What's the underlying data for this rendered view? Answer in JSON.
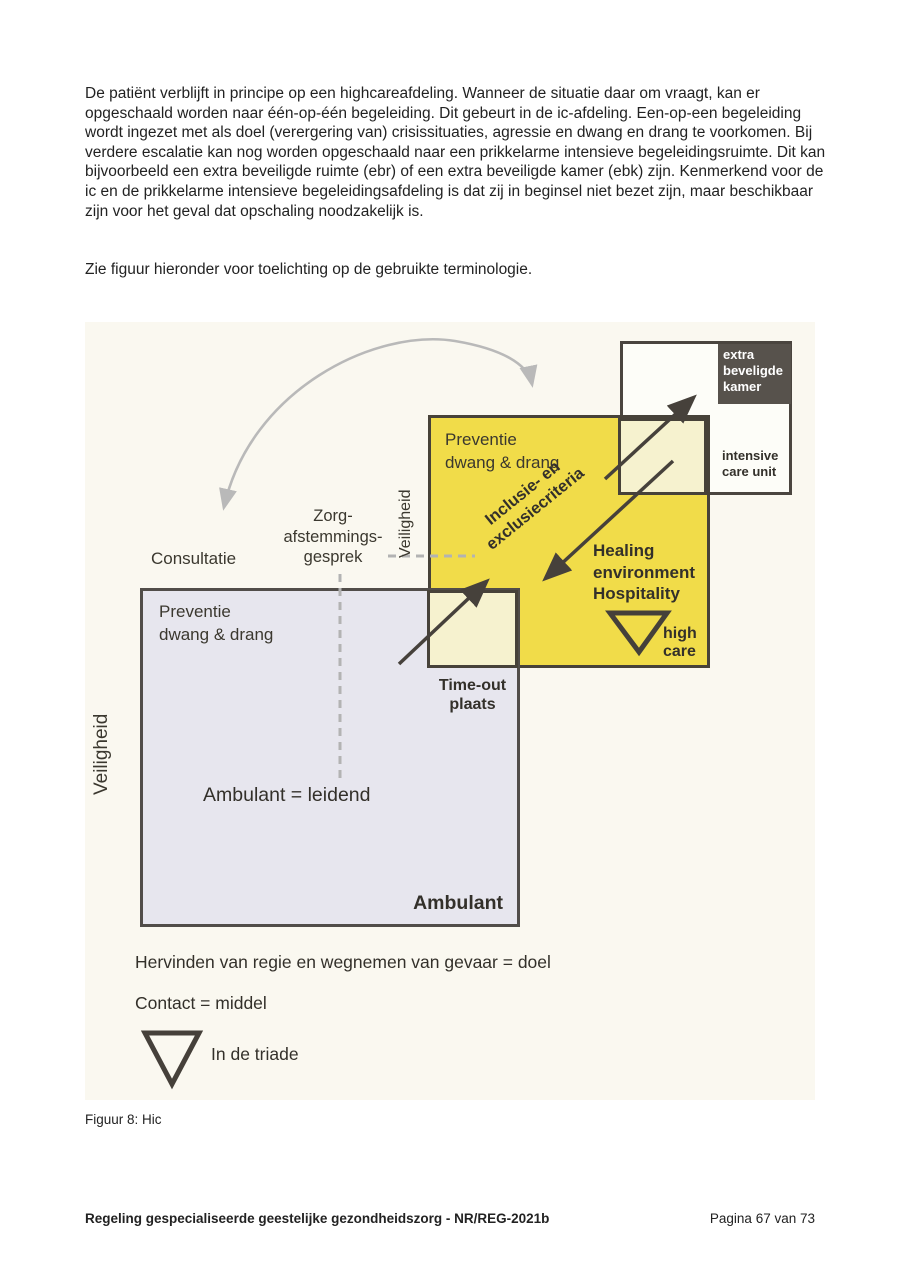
{
  "page": {
    "body_paragraph": "De patiënt verblijft in principe op een highcareafdeling. Wanneer de situatie daar om vraagt, kan er opgeschaald worden naar één-op-één begeleiding. Dit gebeurt in de ic-afdeling. Een-op-een begeleiding wordt ingezet met als doel (verergering van) crisissituaties, agressie en dwang en drang te voorkomen. Bij verdere escalatie kan nog worden opgeschaald naar een prikkelarme intensieve begeleidingsruimte. Dit kan bijvoorbeeld een extra beveiligde ruimte (ebr) of een extra beveiligde kamer (ebk) zijn. Kenmerkend voor de ic en de prikkelarme intensieve begeleidingsafdeling is dat zij in beginsel niet bezet zijn, maar beschikbaar zijn voor het geval dat opschaling noodzakelijk is.",
    "figure_intro": "Zie figuur hieronder voor toelichting op de gebruikte terminologie.",
    "caption": "Figuur 8: Hic",
    "footer_left": "Regeling gespecialiseerde geestelijke gezondheidszorg - NR/REG-2021b",
    "footer_right": "Pagina 67 van 73"
  },
  "figure": {
    "labels": {
      "ebk": "extra\nbeveligde\nkamer",
      "icu": "intensive\ncare unit",
      "preventie_top": "Preventie\ndwang & drang",
      "veiligheid_top": "Veiligheid",
      "inclusie": "Inclusie- en\nexclusiecriteria",
      "healing": "Healing\nenvironment\nHospitality",
      "high_care": "high\ncare",
      "zorg": "Zorg-\nafstemmings-\ngesprek",
      "consultatie": "Consultatie",
      "preventie_bottom": "Preventie\ndwang & drang",
      "veiligheid_left": "Veiligheid",
      "timeout": "Time-out\nplaats",
      "ambulant_leidend": "Ambulant = leidend",
      "ambulant": "Ambulant",
      "hervinden": "Hervinden van regie en wegnemen van gevaar = doel",
      "contact": "Contact = middel",
      "triade": "In de triade"
    },
    "colors": {
      "figure_background": "#faf8f0",
      "highcare_yellow": "#f1dc49",
      "pale_corner": "#f6f2cf",
      "ambulant_gray": "#e7e6ee",
      "ebk_dark": "#57524c",
      "box_border": "#474239",
      "arrow_dark": "#46413b",
      "arrow_light_gray": "#b9b9b9"
    }
  }
}
